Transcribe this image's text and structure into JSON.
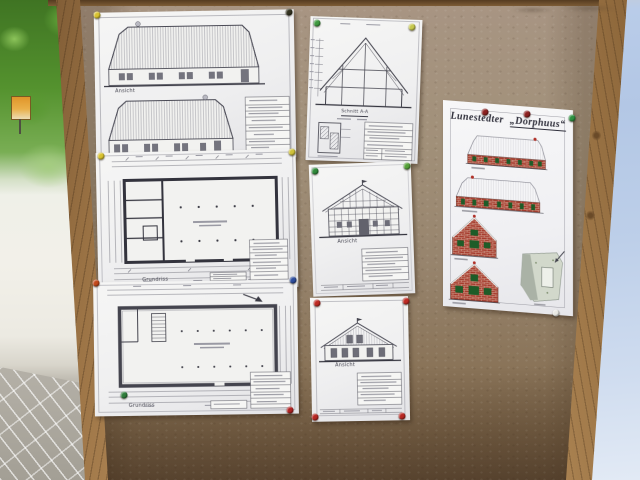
{
  "scene": {
    "description": "Outdoor cork notice board with seven pinned architectural drawing sheets of a thatched farmhouse, beside trees, a paved walkway and a light blue tarp"
  },
  "palette": {
    "cork_light": "#a69381",
    "cork_dark": "#5c4935",
    "frame_wood": "#b08a57",
    "paper": "#f3f3f2",
    "ink": "#42424c",
    "brick_red": "#a63a2c",
    "window_green": "#1e5c28",
    "tarp_blue": "#b5c9e6",
    "foliage_green": "#5d9a34"
  },
  "sheets": {
    "left_elevations": {
      "title": "Long side elevations",
      "label_top": "Ansicht",
      "label_bottom": "Ansicht"
    },
    "left_plan_ground": {
      "title": "Floor plan",
      "label": "Grundriss"
    },
    "left_plan_upper": {
      "title": "Floor plan",
      "label": "Grundriss"
    },
    "mid_section": {
      "title": "Cross section",
      "label": "Schnitt A-A"
    },
    "mid_gable_front": {
      "title": "Timber-frame gable elevation",
      "label": "Ansicht"
    },
    "mid_gable_rear": {
      "title": "Gable elevation",
      "label": "Ansicht"
    },
    "right_presentation": {
      "title_part1": "Lunestedter",
      "title_part2": "„Dorphuus“"
    }
  },
  "pins": [
    {
      "name": "yellow",
      "color": "#d8c22f",
      "x": 97,
      "y": 15
    },
    {
      "name": "black",
      "color": "#33321f",
      "x": 289,
      "y": 12
    },
    {
      "name": "yellow",
      "color": "#d8c22f",
      "x": 101,
      "y": 156
    },
    {
      "name": "yellow",
      "color": "#cfc13a",
      "x": 292,
      "y": 152
    },
    {
      "name": "red",
      "color": "#c2491c",
      "x": 96,
      "y": 283
    },
    {
      "name": "blue",
      "color": "#2d4d9e",
      "x": 293,
      "y": 280
    },
    {
      "name": "green",
      "color": "#2f7d3b",
      "x": 124,
      "y": 395
    },
    {
      "name": "red",
      "color": "#b02423",
      "x": 290,
      "y": 410
    },
    {
      "name": "green",
      "color": "#3f9a3f",
      "x": 317,
      "y": 23
    },
    {
      "name": "yellow-green",
      "color": "#c6c84e",
      "x": 412,
      "y": 27
    },
    {
      "name": "green",
      "color": "#2f8a3a",
      "x": 315,
      "y": 171
    },
    {
      "name": "green",
      "color": "#57a23a",
      "x": 407,
      "y": 166
    },
    {
      "name": "red",
      "color": "#bf2b24",
      "x": 317,
      "y": 303
    },
    {
      "name": "red",
      "color": "#bf2b24",
      "x": 406,
      "y": 301
    },
    {
      "name": "red",
      "color": "#b72722",
      "x": 315,
      "y": 417
    },
    {
      "name": "red",
      "color": "#b72722",
      "x": 402,
      "y": 416
    },
    {
      "name": "dark-red",
      "color": "#8c2120",
      "x": 485,
      "y": 112
    },
    {
      "name": "dark-red",
      "color": "#8c2120",
      "x": 527,
      "y": 114
    },
    {
      "name": "green",
      "color": "#2e9141",
      "x": 572,
      "y": 118
    },
    {
      "name": "white",
      "color": "#e9e9e4",
      "x": 556,
      "y": 313
    }
  ]
}
